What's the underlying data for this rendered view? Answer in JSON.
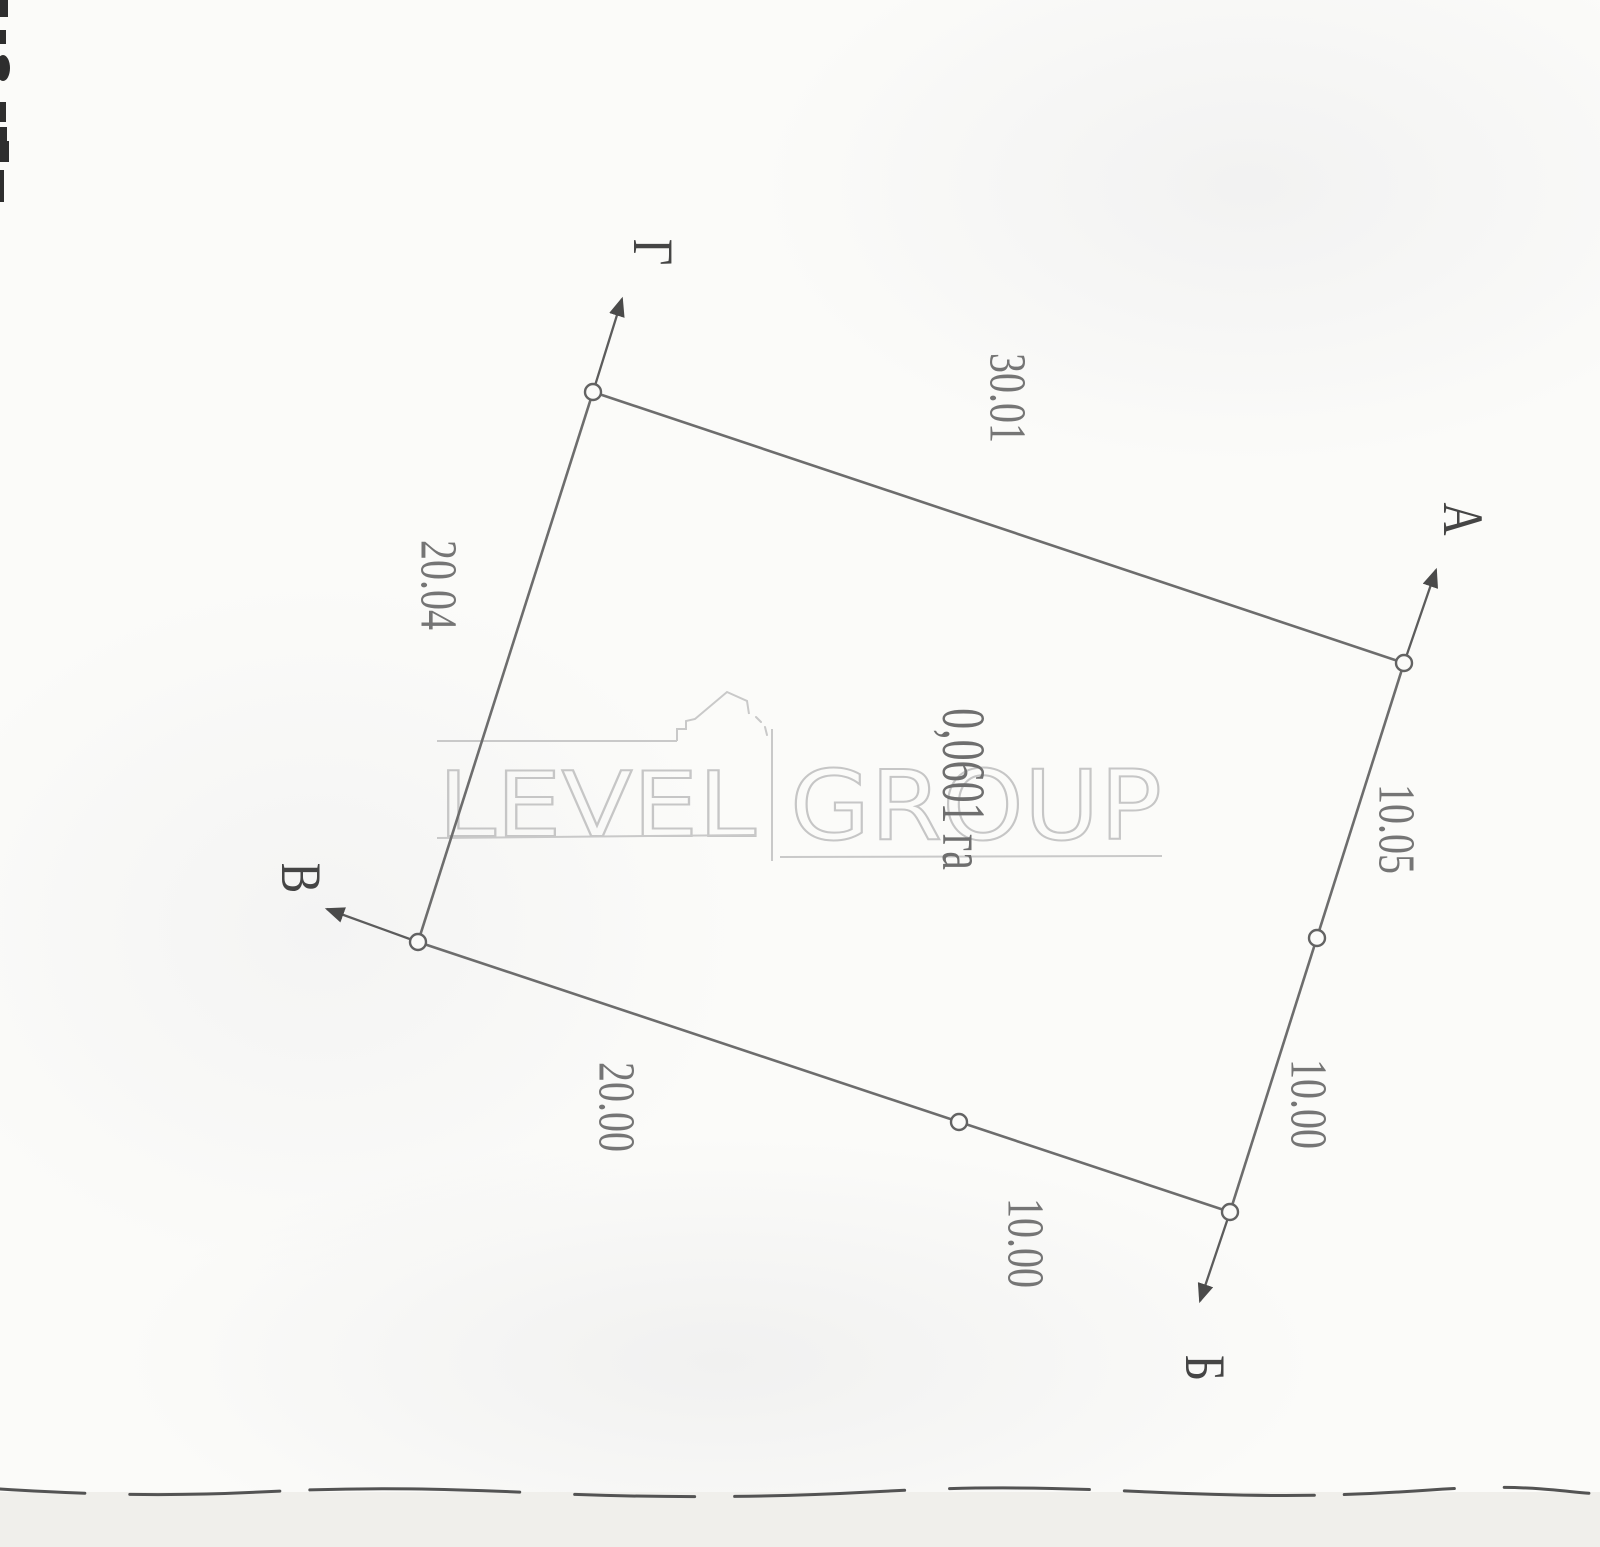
{
  "plot": {
    "area_label": "0,0601 га",
    "corners": [
      {
        "id": "g",
        "label": "Г"
      },
      {
        "id": "a",
        "label": "А"
      },
      {
        "id": "b",
        "label": "Б"
      },
      {
        "id": "v",
        "label": "В"
      }
    ],
    "dimensions": [
      {
        "edge": "top",
        "value": "30.01"
      },
      {
        "edge": "left",
        "value": "20.04"
      },
      {
        "edge": "right-upper",
        "value": "10.05"
      },
      {
        "edge": "right-lower",
        "value": "10.00"
      },
      {
        "edge": "bottom-right",
        "value": "10.00"
      },
      {
        "edge": "bottom-left",
        "value": "20.00"
      }
    ]
  },
  "watermark": {
    "left_word": "LEVEL",
    "right_word": "GROUP"
  },
  "colors": {
    "paper": "#fbfbf9",
    "boundary_line": "#6d6d6d",
    "label_text": "#757575",
    "corner_text": "#454545",
    "watermark": "#c6c6c6"
  }
}
